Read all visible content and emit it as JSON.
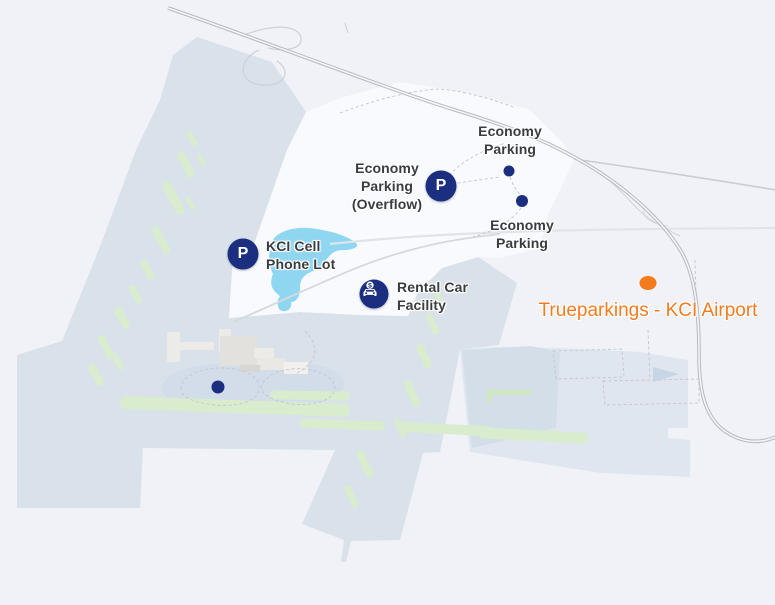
{
  "map": {
    "description": "KCI airport area map with parking points of interest",
    "colors": {
      "background": "#f0f2f8",
      "airport_grounds": "#d9e1ea",
      "airport_grounds_light": "#e0e6ef",
      "runway_green": "#d9ecce",
      "water_blue": "#8fd6f0",
      "marker_navy": "#1c2e80",
      "selected_orange": "#f57b1d",
      "label_text": "#3a3d40"
    },
    "markers": {
      "economy_parking_north": {
        "lines": [
          "Economy",
          "Parking"
        ]
      },
      "economy_parking_overflow": {
        "lines": [
          "Economy",
          "Parking",
          "(Overflow)"
        ]
      },
      "economy_parking_south": {
        "lines": [
          "Economy",
          "Parking"
        ]
      },
      "kci_cell_phone_lot": {
        "lines": [
          "KCI Cell",
          "Phone Lot"
        ]
      },
      "rental_car_facility": {
        "lines": [
          "Rental Car",
          "Facility"
        ]
      },
      "trueparkings": {
        "label": "Trueparkings - KCI Airport"
      }
    },
    "icons": {
      "parking_letter": "P",
      "currency_symbol": "$"
    }
  }
}
